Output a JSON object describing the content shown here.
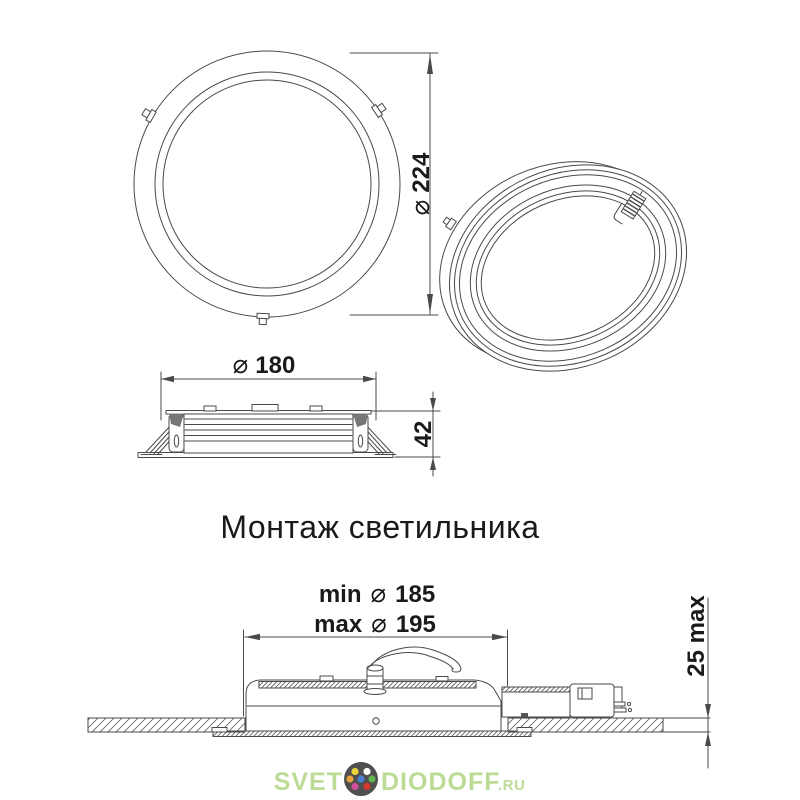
{
  "drawing": {
    "title": "Монтаж светильника",
    "line_color": "#4a4a4a",
    "text_color": "#1a1a1a",
    "front_view": {
      "dim_symbol": "⌀",
      "dim_value": "224"
    },
    "side_view": {
      "dim_symbol": "⌀",
      "dim_value": "180",
      "height_value": "42"
    },
    "installation": {
      "min_prefix": "min",
      "min_symbol": "⌀",
      "min_value": "185",
      "max_prefix": "max",
      "max_symbol": "⌀",
      "max_value": "195",
      "depth_value": "25 max"
    }
  },
  "watermark": {
    "part1": "SVET",
    "part2": "DIODOFF",
    "tld": ".RU",
    "text_color": "#bcdc96",
    "logo_circle_color": "#4f4f4f",
    "logo_dots": [
      "#e9d43c",
      "#ffffff",
      "#e8a23d",
      "#4a80d1",
      "#62b44e",
      "#cf4f9b",
      "#d23a2d"
    ]
  }
}
